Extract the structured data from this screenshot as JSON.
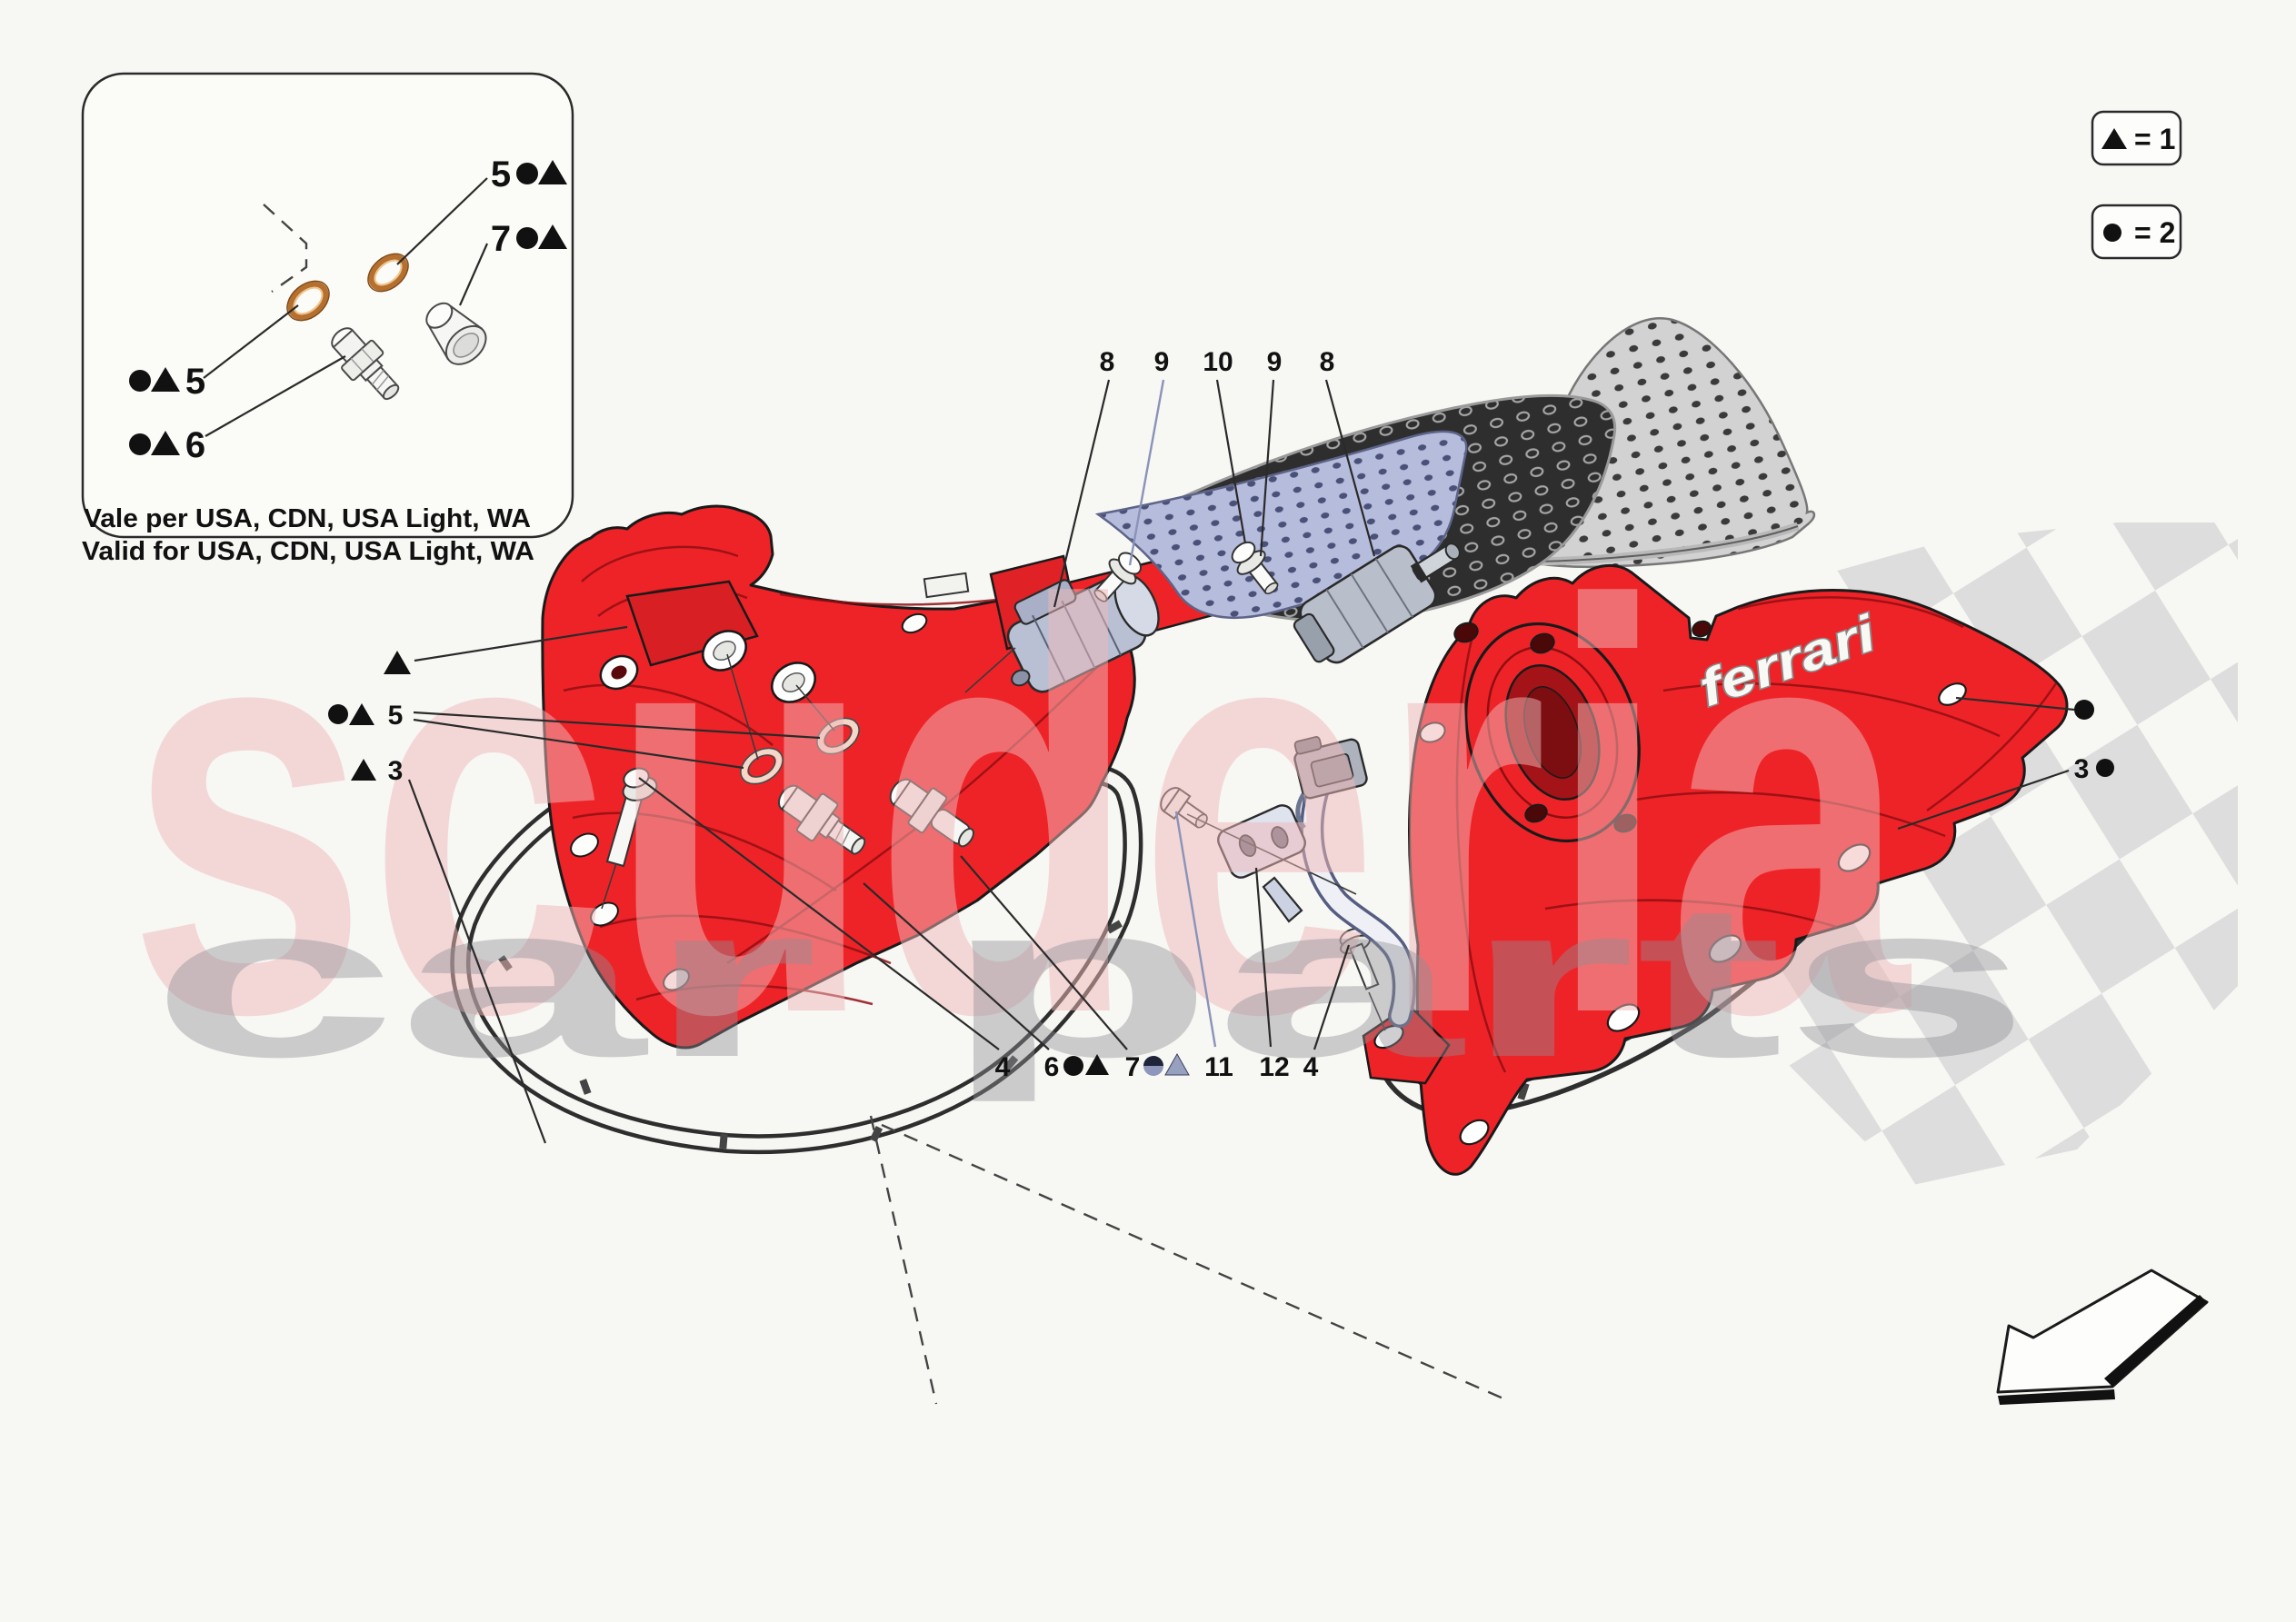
{
  "legend": {
    "items": [
      {
        "symbol": "triangle-icon",
        "label": "= 1"
      },
      {
        "symbol": "circle-icon",
        "label": "= 2"
      }
    ]
  },
  "inset": {
    "callouts": {
      "top_5": "5",
      "top_7": "7",
      "left_5": "5",
      "left_6": "6"
    },
    "note_line1": "Vale per USA, CDN, USA Light, WA",
    "note_line2": "Valid for USA, CDN, USA Light, WA"
  },
  "callouts": {
    "top": [
      "8",
      "9",
      "10",
      "9",
      "8"
    ],
    "bottom_4a": "4",
    "bottom_6": "6",
    "bottom_7": "7",
    "bottom_11": "11",
    "bottom_12": "12",
    "bottom_4b": "4",
    "left_5": "5",
    "left_3": "3",
    "right_3": "3"
  },
  "cover_script": "ferrari",
  "watermark": {
    "brand": "scuderia",
    "tagline": "car parts"
  },
  "colors": {
    "ferrari_red": "#ee2328",
    "red_shadow": "#c8161b",
    "copper": "#b5702f",
    "shield_blue": "#b6bcdc",
    "carbon_dark": "#2e2e2e",
    "carbon_light": "#d2d2d2",
    "checker_gray": "#dcdcdc",
    "watermark_pink": "#f0b9b9",
    "watermark_gray": "#8f8f96",
    "leader_blue": "#8a93b8",
    "wire_blue": "#7d88a8"
  }
}
